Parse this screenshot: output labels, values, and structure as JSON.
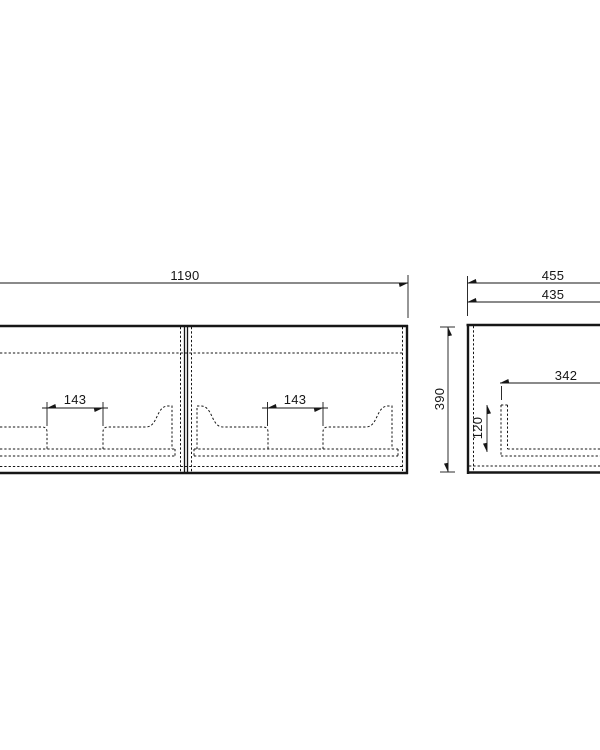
{
  "page": {
    "background": "#ffffff",
    "line_color": "#161616"
  },
  "views": {
    "front": {
      "label": "front-view",
      "dimensions": {
        "overall_width": "1190",
        "overall_height": "390",
        "left_cutout_width": "143",
        "right_cutout_width": "143"
      }
    },
    "side": {
      "label": "side-view",
      "dimensions": {
        "overall_depth": "455",
        "carcass_depth": "435",
        "inner_depth": "342",
        "inner_height": "120"
      }
    }
  }
}
